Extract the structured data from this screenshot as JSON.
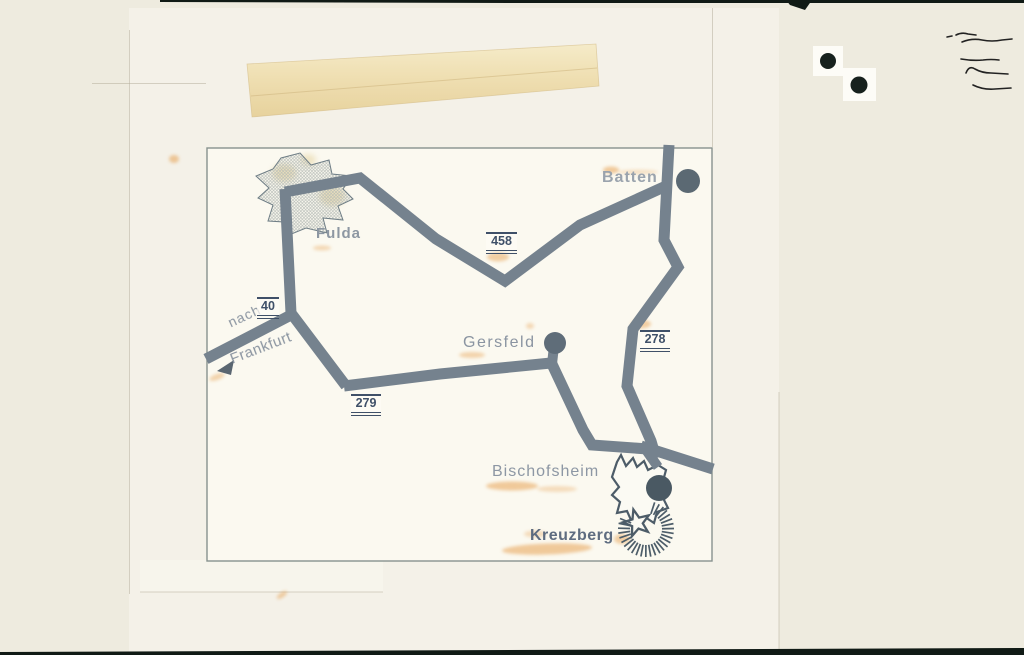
{
  "photo": {
    "colors": {
      "road": "#75828e",
      "strip": "#101a15",
      "dot": "#17211d",
      "pen": "#222222"
    },
    "layers": [
      {
        "name": "photo-base",
        "x": 0,
        "y": 0,
        "w": 1024,
        "h": 655,
        "color": "#eeebdf"
      },
      {
        "name": "paper-sheet",
        "x": 129,
        "y": 8,
        "w": 650,
        "h": 647,
        "color": "#f4f1e8"
      },
      {
        "name": "bottom-light-patch",
        "x": 140,
        "y": 560,
        "w": 243,
        "h": 32,
        "color": "#f7f5ec"
      },
      {
        "name": "map-panel",
        "x": 207,
        "y": 148,
        "w": 505,
        "h": 413,
        "color": "#fbf9f0"
      }
    ],
    "faint_edge_color": "rgba(178,172,152,0.5)",
    "faint_edges": [
      [
        712.5,
        8,
        712.5,
        147
      ],
      [
        779,
        392,
        779,
        649
      ],
      [
        129.5,
        30,
        129.5,
        594
      ],
      [
        92,
        83.5,
        206,
        83.5
      ],
      [
        140,
        592,
        383,
        592
      ]
    ],
    "tape": {
      "points": [
        [
          247,
          64
        ],
        [
          596,
          44
        ],
        [
          599,
          86
        ],
        [
          252,
          117
        ]
      ],
      "crease": [
        251,
        96,
        597,
        68
      ],
      "crease_color": "rgba(205,180,125,0.55)",
      "edge_color": "rgba(210,185,130,0.6)"
    },
    "top_strip": [
      [
        160,
        0
      ],
      [
        1024,
        0
      ],
      [
        1024,
        3
      ],
      [
        520,
        3
      ],
      [
        160,
        2
      ]
    ],
    "top_wedge": [
      [
        786,
        0
      ],
      [
        812,
        0
      ],
      [
        805,
        10
      ],
      [
        790,
        5
      ]
    ],
    "bottom_strip": [
      [
        0,
        652
      ],
      [
        1024,
        648
      ],
      [
        1024,
        655
      ],
      [
        0,
        655
      ]
    ],
    "black_dots": [
      {
        "x": 828,
        "y": 61,
        "r": 8,
        "px": 813,
        "py": 46,
        "pw": 30,
        "ph": 30
      },
      {
        "x": 859,
        "y": 85,
        "r": 8.5,
        "px": 843,
        "py": 68,
        "pw": 33,
        "ph": 33
      }
    ],
    "patch_color": "#fdfcf7",
    "pen_scribbles": [
      "M947,37 l5,-1 M956,35 q6,-3 12,-1 l8,1",
      "M962,42 q10,-4 20,-2 q10,2 20,0 l10,-1",
      "M961,59 q12,2 22,1 q8,-1 16,0",
      "M966,73 q3,-8 9,-4 q7,4 16,4 l17,1",
      "M973,85 q10,5 22,4 l16,-1"
    ]
  },
  "map": {
    "frame": {
      "x": 207,
      "y": 148,
      "w": 505,
      "h": 413,
      "color": "#87928e"
    },
    "roads": [
      {
        "name": "road-458",
        "width": 11,
        "points": [
          [
            285,
            192
          ],
          [
            360,
            178
          ],
          [
            436,
            239
          ],
          [
            505,
            281
          ],
          [
            580,
            225
          ],
          [
            666,
            186
          ]
        ]
      },
      {
        "name": "road-278-batten",
        "width": 11,
        "points": [
          [
            669,
            145
          ],
          [
            664,
            240
          ],
          [
            678,
            267
          ],
          [
            633,
            329
          ],
          [
            627,
            386
          ],
          [
            651,
            441
          ],
          [
            656,
            458
          ]
        ]
      },
      {
        "name": "road-fulda-south",
        "width": 11,
        "points": [
          [
            285,
            189
          ],
          [
            291,
            313
          ],
          [
            346,
            386
          ]
        ]
      },
      {
        "name": "road-40-frankfurt",
        "width": 11,
        "points": [
          [
            291,
            315
          ],
          [
            206,
            359
          ]
        ]
      },
      {
        "name": "road-279",
        "width": 11,
        "points": [
          [
            344,
            386
          ],
          [
            440,
            374
          ],
          [
            551,
            363
          ]
        ]
      },
      {
        "name": "road-gersfeld-stub",
        "width": 10,
        "points": [
          [
            554,
            346
          ],
          [
            552,
            364
          ]
        ]
      },
      {
        "name": "road-gersfeld-bischofsheim",
        "width": 11,
        "points": [
          [
            551,
            362
          ],
          [
            583,
            430
          ],
          [
            592,
            445
          ],
          [
            648,
            449
          ]
        ]
      },
      {
        "name": "road-exit-east",
        "width": 11,
        "points": [
          [
            641,
            446
          ],
          [
            713,
            469
          ]
        ]
      },
      {
        "name": "road-junction-stub",
        "width": 10,
        "points": [
          [
            644,
            447
          ],
          [
            658,
            467
          ]
        ]
      }
    ],
    "town_dots": [
      {
        "name": "batten-dot",
        "cx": 688,
        "cy": 181,
        "r": 12,
        "color": "#5b6973"
      },
      {
        "name": "gersfeld-dot",
        "cx": 555,
        "cy": 343,
        "r": 11,
        "color": "#5f6d79"
      },
      {
        "name": "bischofsheim-dot",
        "cx": 659,
        "cy": 488,
        "r": 13,
        "color": "#4a5963"
      }
    ],
    "fulda_star": {
      "outline": "#6e7d85",
      "points": [
        [
          300,
          153
        ],
        [
          311,
          165
        ],
        [
          329,
          160
        ],
        [
          332,
          174
        ],
        [
          352,
          176
        ],
        [
          343,
          189
        ],
        [
          353,
          199
        ],
        [
          338,
          206
        ],
        [
          343,
          220
        ],
        [
          323,
          218
        ],
        [
          327,
          233
        ],
        [
          306,
          228
        ],
        [
          289,
          235
        ],
        [
          284,
          222
        ],
        [
          268,
          221
        ],
        [
          273,
          205
        ],
        [
          258,
          198
        ],
        [
          269,
          188
        ],
        [
          256,
          176
        ],
        [
          273,
          169
        ],
        [
          281,
          158
        ]
      ]
    },
    "bischofsheim_outline": {
      "outline": "#4d5c68",
      "fill": "#fbfaf3",
      "points": [
        [
          617,
          462
        ],
        [
          621,
          455
        ],
        [
          626,
          466
        ],
        [
          633,
          458
        ],
        [
          637,
          467
        ],
        [
          644,
          461
        ],
        [
          648,
          470
        ],
        [
          658,
          465
        ],
        [
          666,
          470
        ],
        [
          663,
          481
        ],
        [
          668,
          490
        ],
        [
          664,
          500
        ],
        [
          668,
          508
        ],
        [
          657,
          512
        ],
        [
          654,
          523
        ],
        [
          645,
          517
        ],
        [
          638,
          524
        ],
        [
          631,
          520
        ],
        [
          627,
          511
        ],
        [
          617,
          513
        ],
        [
          620,
          502
        ],
        [
          612,
          495
        ],
        [
          619,
          487
        ],
        [
          612,
          477
        ]
      ]
    },
    "kreuzberg_star": {
      "cx": 637,
      "cy": 523,
      "r_outer": 14,
      "r_inner": 5.8,
      "rotation": -15,
      "outline": "#4d5c68",
      "fill": "#fbfaf3"
    },
    "kreuzberg_rays": {
      "cx": 646,
      "cy": 529,
      "r_in": 16,
      "r_out": 28,
      "start_deg": -72,
      "end_deg": 202,
      "count": 28,
      "color": "#4d5d69",
      "width": 1.7
    },
    "frankfurt_arrow": {
      "points": [
        [
          217,
          371
        ],
        [
          234,
          360
        ],
        [
          231,
          375
        ]
      ],
      "color": "#5a6671"
    },
    "stain_color": "#e59a45",
    "orange_stains": [
      {
        "x": 174,
        "y": 159,
        "rx": 5,
        "ry": 4,
        "op": 0.5,
        "rot": 0
      },
      {
        "x": 322,
        "y": 248,
        "rx": 9,
        "ry": 2.5,
        "op": 0.35,
        "rot": 0
      },
      {
        "x": 498,
        "y": 257,
        "rx": 11,
        "ry": 4.5,
        "op": 0.45,
        "rot": 0
      },
      {
        "x": 611,
        "y": 170,
        "rx": 8,
        "ry": 3.5,
        "op": 0.5,
        "rot": 0
      },
      {
        "x": 638,
        "y": 172,
        "rx": 20,
        "ry": 2.5,
        "op": 0.25,
        "rot": 0
      },
      {
        "x": 641,
        "y": 324,
        "rx": 10,
        "ry": 4.5,
        "op": 0.45,
        "rot": 0
      },
      {
        "x": 472,
        "y": 355,
        "rx": 13,
        "ry": 3,
        "op": 0.4,
        "rot": 0
      },
      {
        "x": 530,
        "y": 326,
        "rx": 4,
        "ry": 3,
        "op": 0.35,
        "rot": 0
      },
      {
        "x": 512,
        "y": 486,
        "rx": 26,
        "ry": 4.5,
        "op": 0.5,
        "rot": 0
      },
      {
        "x": 557,
        "y": 489,
        "rx": 20,
        "ry": 3,
        "op": 0.3,
        "rot": 0
      },
      {
        "x": 547,
        "y": 549,
        "rx": 45,
        "ry": 5.5,
        "op": 0.5,
        "rot": -2
      },
      {
        "x": 622,
        "y": 539,
        "rx": 8,
        "ry": 5,
        "op": 0.45,
        "rot": 0
      },
      {
        "x": 535,
        "y": 534,
        "rx": 11,
        "ry": 3.5,
        "op": 0.3,
        "rot": 0
      },
      {
        "x": 282,
        "y": 595,
        "rx": 6,
        "ry": 2.5,
        "op": 0.45,
        "rot": -35
      },
      {
        "x": 217,
        "y": 377,
        "rx": 8,
        "ry": 3,
        "op": 0.4,
        "rot": -20
      }
    ],
    "yellow_stain_color": "#dfca8e",
    "yellow_stains": [
      {
        "x": 284,
        "y": 173,
        "rx": 12,
        "ry": 9,
        "op": 0.55
      },
      {
        "x": 332,
        "y": 196,
        "rx": 13,
        "ry": 10,
        "op": 0.55
      },
      {
        "x": 308,
        "y": 160,
        "rx": 8,
        "ry": 6,
        "op": 0.45
      }
    ],
    "labels": {
      "fulda": {
        "text": "Fulda",
        "x": 316,
        "y": 226,
        "size": 15,
        "weight": "bold",
        "color": "#8d97a2",
        "angle": 0,
        "spacing": 1
      },
      "batten": {
        "text": "Batten",
        "x": 602,
        "y": 169,
        "size": 16,
        "weight": "600",
        "color": "#9aa3ad",
        "angle": 0,
        "spacing": 1
      },
      "gersfeld": {
        "text": "Gersfeld",
        "x": 463,
        "y": 334,
        "size": 16,
        "weight": "normal",
        "color": "#8a94a1",
        "angle": 0,
        "spacing": 1.5
      },
      "bischofsheim": {
        "text": "Bischofsheim",
        "x": 492,
        "y": 463,
        "size": 16,
        "weight": "normal",
        "color": "#8d97a4",
        "angle": 0,
        "spacing": 1
      },
      "kreuzberg": {
        "text": "Kreuzberg",
        "x": 530,
        "y": 527,
        "size": 16,
        "weight": "bold",
        "color": "#5e6c80",
        "angle": 0,
        "spacing": 0.5
      },
      "nach": {
        "text": "nach",
        "x": 229,
        "y": 316,
        "size": 14,
        "weight": "normal",
        "color": "#8a94a0",
        "angle": -25,
        "spacing": 1
      },
      "frankfurt": {
        "text": "Frankfurt",
        "x": 231,
        "y": 352,
        "size": 15,
        "weight": "normal",
        "color": "#8a94a0",
        "angle": -21,
        "spacing": 0.5
      }
    },
    "signs": {
      "s40": {
        "text": "40",
        "x": 257,
        "y": 297,
        "w": 22,
        "color": "#3f5068"
      },
      "s458": {
        "text": "458",
        "x": 486,
        "y": 232,
        "w": 31,
        "color": "#3f5068"
      },
      "s279": {
        "text": "279",
        "x": 351,
        "y": 394,
        "w": 30,
        "color": "#3f5068"
      },
      "s278": {
        "text": "278",
        "x": 640,
        "y": 330,
        "w": 30,
        "color": "#3f5068"
      }
    }
  }
}
